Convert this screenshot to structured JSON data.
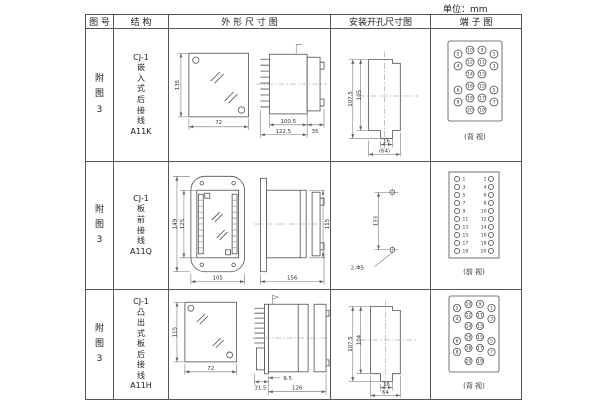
{
  "unit_label": "单位：mm",
  "header": {
    "fig": "图 号",
    "struct": "结 构",
    "outline": "外 形 尺 寸 图",
    "install": "安装开孔尺寸图",
    "terminal": "端 子 图"
  },
  "rows": [
    {
      "fig": "附\n图\n3",
      "struct": "CJ-1\n嵌\n入\n式\n后\n接\n线\nA11K",
      "outline": {
        "front_h": "135",
        "front_w": "72",
        "d1": "100.5",
        "d2": "122.5",
        "d3": "35"
      },
      "install": {
        "outer": "107.5",
        "inner": "105",
        "w1": "16",
        "w2": "(64)"
      },
      "terminal": {
        "caption": "(背 视)",
        "cells": [
          "2",
          "10",
          "9",
          "1",
          "4",
          "12",
          "11",
          "3",
          "14",
          "13",
          "6",
          "16",
          "15",
          "5",
          "8",
          "18",
          "17",
          "7",
          "20",
          "19"
        ]
      }
    },
    {
      "fig": "附\n图\n3",
      "struct": "CJ-1\n板\n前\n接\n线\nA11Q",
      "outline": {
        "front_h_outer": "149",
        "front_h_inner": "125",
        "front_w": "105",
        "side_len": "156",
        "side_h": "115"
      },
      "install": {
        "height": "133",
        "holes": "2-Φ5"
      },
      "terminal": {
        "caption": "(前 视)",
        "left": [
          "1",
          "3",
          "5",
          "7",
          "9",
          "11",
          "13",
          "15",
          "17",
          "19"
        ],
        "right": [
          "2",
          "4",
          "6",
          "8",
          "10",
          "12",
          "14",
          "16",
          "18",
          "20"
        ]
      }
    },
    {
      "fig": "附\n图\n3",
      "struct": "CJ-1\n凸\n出\n式\n板\n后\n接\n线\nA11H",
      "outline": {
        "front_h": "115",
        "front_w": "72",
        "d1": "31.5",
        "d2": "9.5",
        "d3": "126"
      },
      "install": {
        "outer": "107.5",
        "inner": "104",
        "w1": "16",
        "w2": "64"
      },
      "terminal": {
        "caption": "(背 视)",
        "cells": [
          "2",
          "10",
          "9",
          "1",
          "4",
          "12",
          "11",
          "3",
          "14",
          "13",
          "6",
          "16",
          "15",
          "5",
          "8",
          "18",
          "17",
          "7",
          "20",
          "19"
        ]
      }
    }
  ]
}
